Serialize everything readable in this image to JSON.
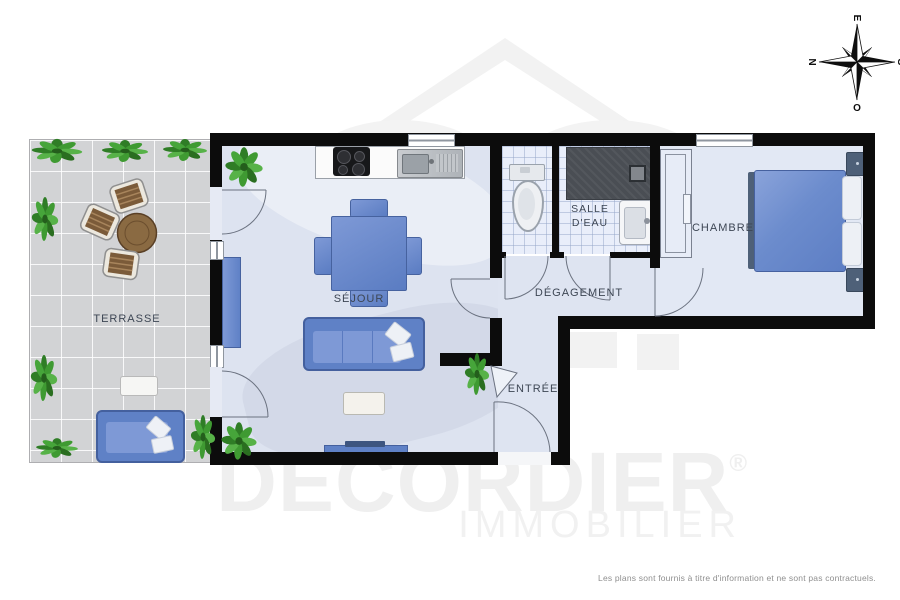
{
  "labels": {
    "terrasse": "TERRASSE",
    "sejour": "SÉJOUR",
    "salle_deau": "SALLE\nD'EAU",
    "degagement": "DÉGAGEMENT",
    "entree": "ENTRÉE",
    "chambre": "CHAMBRE"
  },
  "compass": {
    "north": "N",
    "south": "S",
    "east": "E",
    "west": "O"
  },
  "watermark": {
    "brand": "DECORDIER",
    "registered": "®",
    "subtitle": "IMMOBILIER"
  },
  "footer": {
    "disclaimer": "Les plans sont fournis à titre d'information et ne sont pas contractuels."
  },
  "colors": {
    "wall": "#0c0c0c",
    "floor": "#dde3f0",
    "tile_floor": "#e9eefa",
    "terrace_floor": "#d2d3d5",
    "furniture_blue": "#5f81c6",
    "shower_gray": "#4a4e54",
    "wood_brown": "#7b5b39",
    "plant_green": "#3f9a32",
    "watermark_gray": "#efefef",
    "label_text": "#3d4654"
  }
}
